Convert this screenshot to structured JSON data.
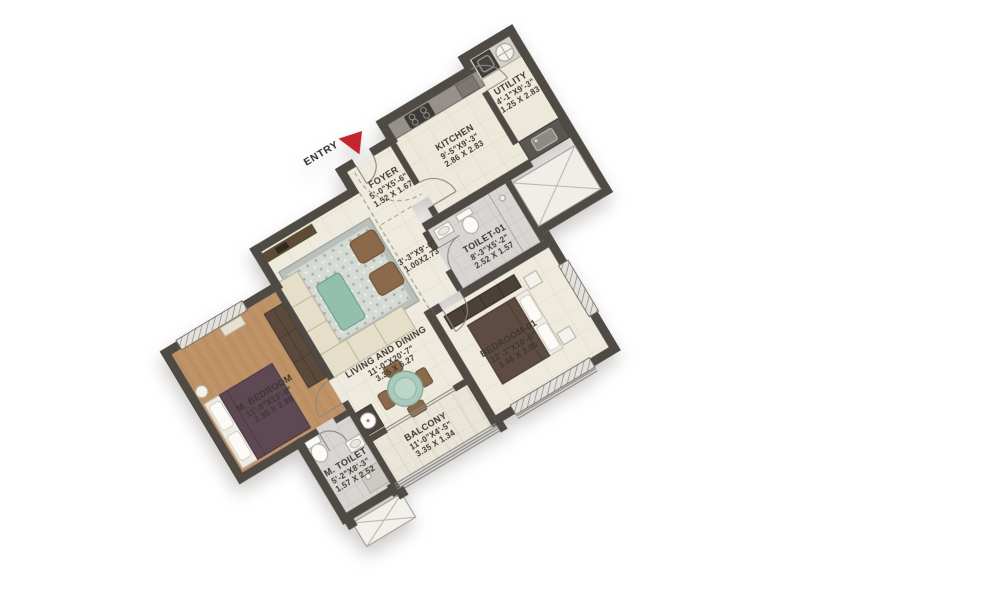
{
  "entry": {
    "label": "ENTRY"
  },
  "colors": {
    "arrow_red": "#c3262c",
    "wall": "#4f4a44",
    "wood_floor": "#bf9266",
    "teal_accent": "#9dc3b4",
    "label_text": "#3c3831"
  },
  "rooms": [
    {
      "id": "m-bedroom",
      "name": "M. BEDROOM",
      "dims_ft": "11'-0\"X13'-0\"",
      "dims_m": "3.35 X 3.96"
    },
    {
      "id": "m-toilet",
      "name": "M. TOILET",
      "dims_ft": "5'-2\"X8'-3\"",
      "dims_m": "1.57 X 2.52"
    },
    {
      "id": "living-dining",
      "name": "LIVING AND DINING",
      "dims_ft": "11'-0\"X20'-7\"",
      "dims_m": "3.35 X 6.27"
    },
    {
      "id": "foyer",
      "name": "FOYER",
      "dims_ft": "5'-0\"X5'-6\"",
      "dims_m": "1.52 X 1.67"
    },
    {
      "id": "passage",
      "name": "",
      "dims_ft": "3'-3\"X9'-0\"",
      "dims_m": "1.00X2.73"
    },
    {
      "id": "kitchen",
      "name": "KITCHEN",
      "dims_ft": "9'-5\"X9'-3\"",
      "dims_m": "2.86 X 2.83"
    },
    {
      "id": "utility",
      "name": "UTILITY",
      "dims_ft": "4'-1\"X9'-3\"",
      "dims_m": "1.25 X 2.83"
    },
    {
      "id": "toilet-01",
      "name": "TOILET-01",
      "dims_ft": "8'-3\"X5'-2\"",
      "dims_m": "2.52 X 1.57"
    },
    {
      "id": "bedroom-01",
      "name": "BEDROOM-01",
      "dims_ft": "12'-1\"X10'-0\"",
      "dims_m": "3.68 X 3.05"
    },
    {
      "id": "balcony",
      "name": "BALCONY",
      "dims_ft": "11'-0\"X4'-5\"",
      "dims_m": "3.35 X 1.34"
    }
  ]
}
